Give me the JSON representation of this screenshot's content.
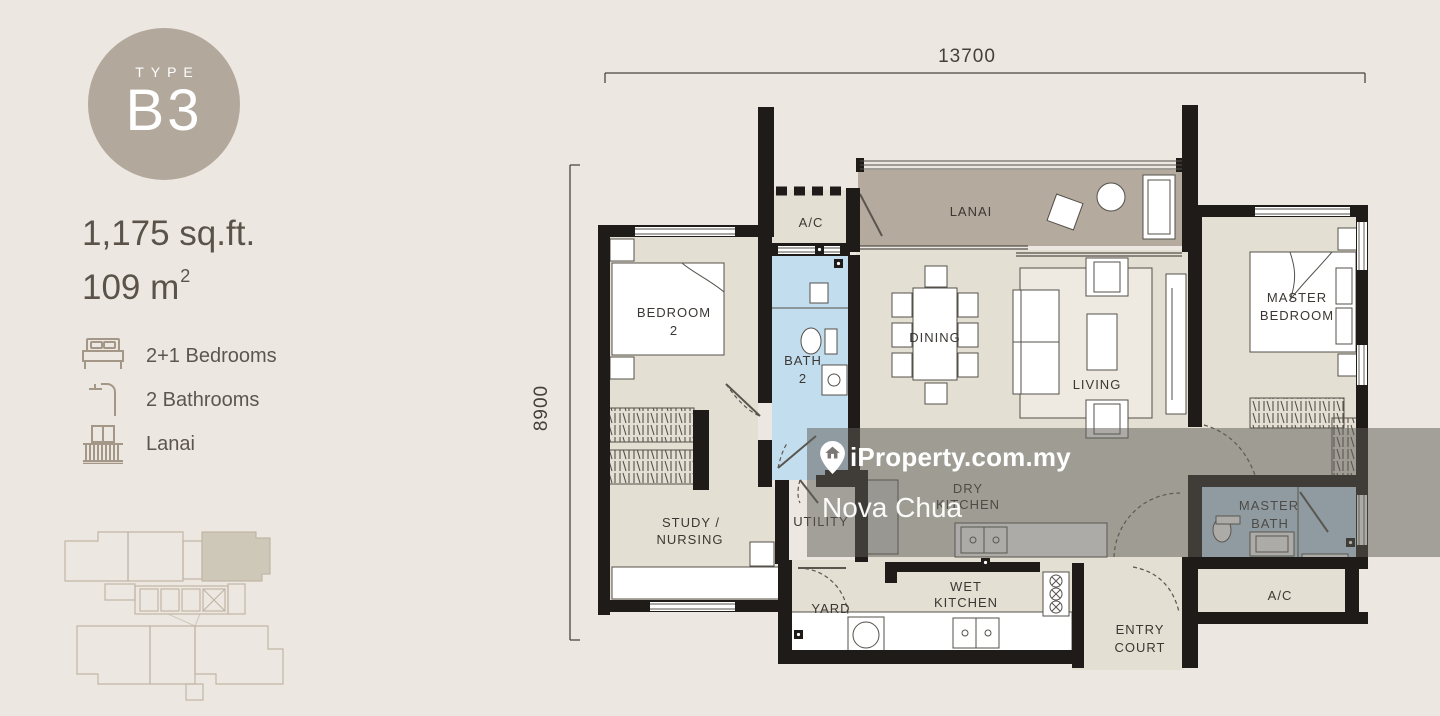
{
  "page": {
    "background": "#ece8e1"
  },
  "badge": {
    "label": "TYPE",
    "code": "B3",
    "circle_color": "#b2a89b",
    "text_color": "#ffffff"
  },
  "unit": {
    "area_sqft": "1,175 sq.ft.",
    "area_m2": "109 m",
    "area_m2_sup": "2"
  },
  "features": [
    {
      "icon": "bed-icon",
      "label": "2+1 Bedrooms"
    },
    {
      "icon": "shower-icon",
      "label": "2 Bathrooms"
    },
    {
      "icon": "balcony-icon",
      "label": "Lanai"
    }
  ],
  "dimensions": {
    "width_mm": "13700",
    "depth_mm": "8900"
  },
  "rooms": {
    "bedroom2_l1": "BEDROOM",
    "bedroom2_l2": "2",
    "ac_top": "A/C",
    "lanai": "LANAI",
    "bath2_l1": "BATH",
    "bath2_l2": "2",
    "dining": "DINING",
    "living": "LIVING",
    "master_bedroom_l1": "MASTER",
    "master_bedroom_l2": "BEDROOM",
    "dry_kitchen_l1": "DRY",
    "dry_kitchen_l2": "KITCHEN",
    "utility": "UTILITY",
    "study_l1": "STUDY /",
    "study_l2": "NURSING",
    "yard": "YARD",
    "wet_kitchen_l1": "WET",
    "wet_kitchen_l2": "KITCHEN",
    "master_bath_l1": "MASTER",
    "master_bath_l2": "BATH",
    "ac_bottom": "A/C",
    "entry_l1": "ENTRY",
    "entry_l2": "COURT"
  },
  "watermark": {
    "brand": "iProperty.com.my",
    "agent": "Nova Chua"
  },
  "plan_colors": {
    "wall": "#1e1b18",
    "floor": "#e4dfd3",
    "lanai_floor": "#b4aa9e",
    "bath_floor": "#c2ddee",
    "rug": "#eeeae1",
    "keyplan_line": "#c3b5a5",
    "keyplan_highlight": "#cdc8b8"
  }
}
